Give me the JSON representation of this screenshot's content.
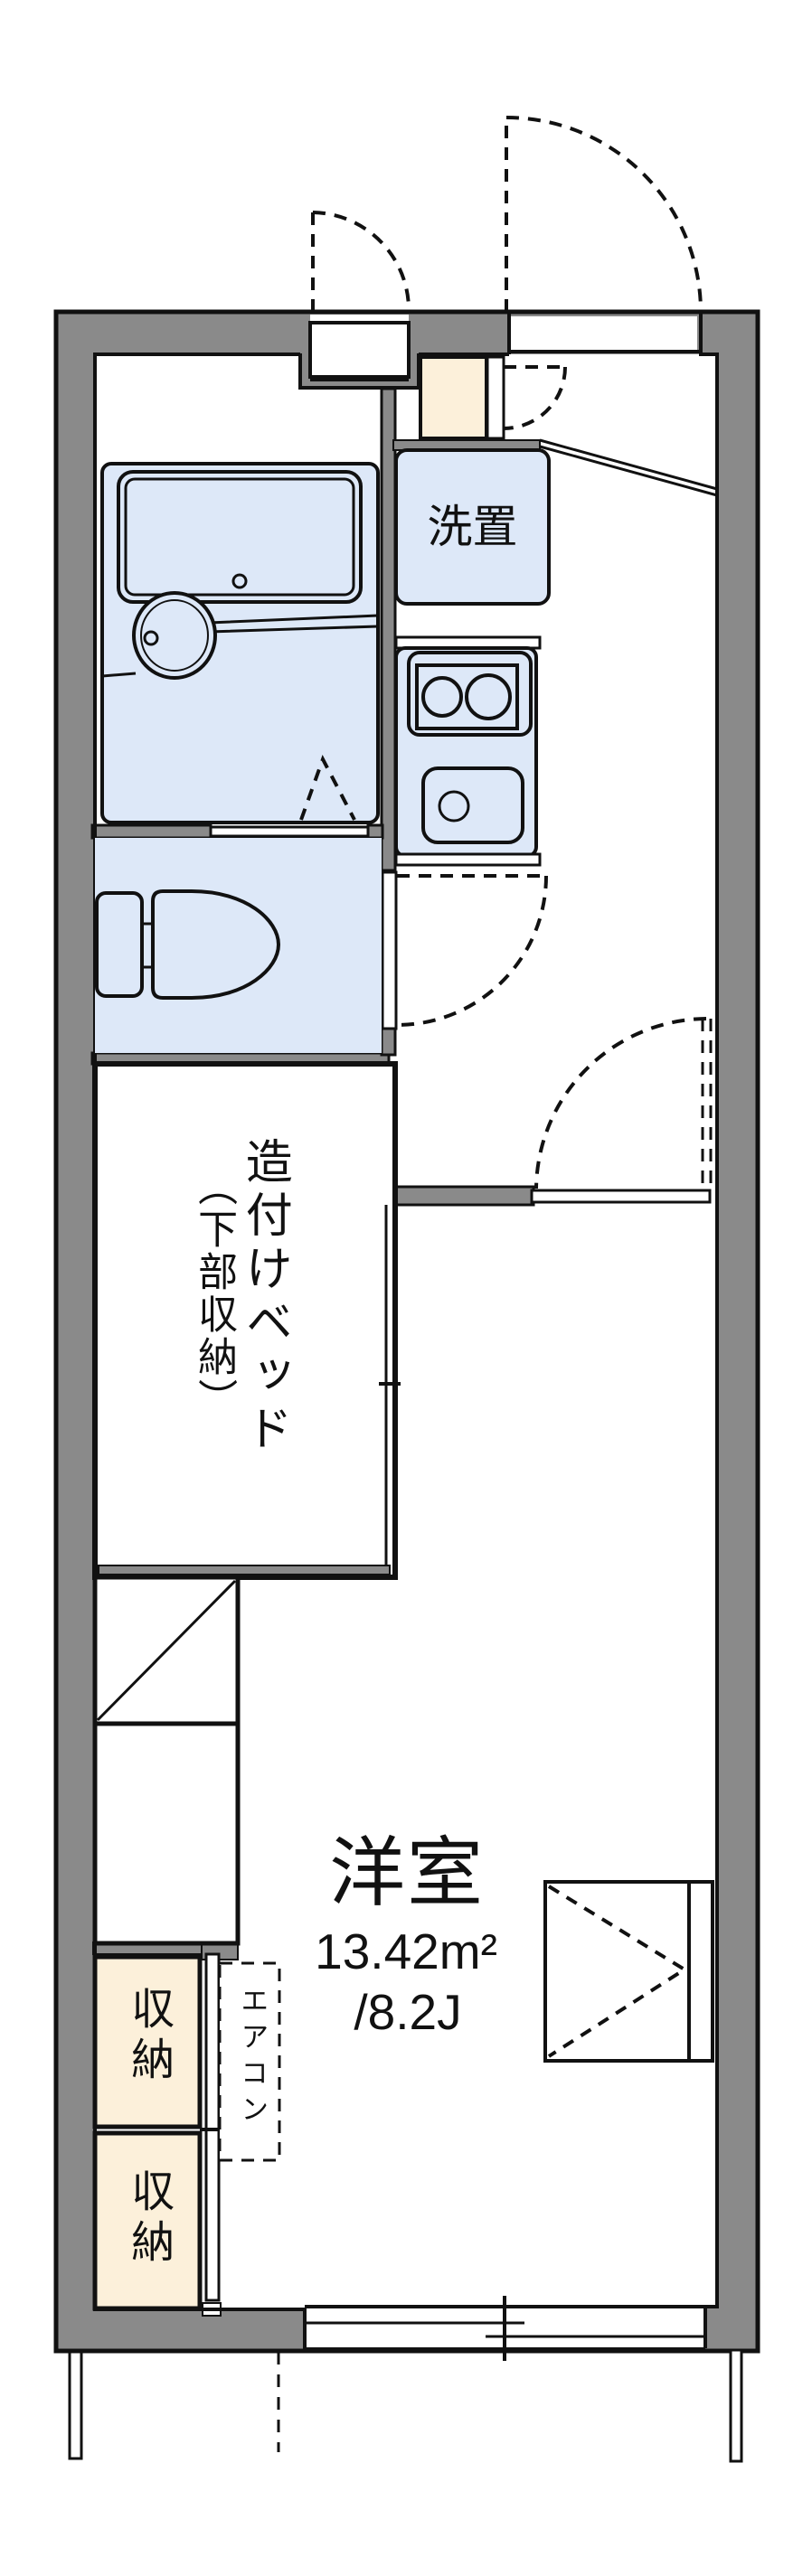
{
  "floorplan": {
    "labels": {
      "washer_area": "洗置",
      "bed_line1": "造付けベッド",
      "bed_line2": "（下部収納）",
      "room_name": "洋室",
      "room_area": "13.42m²",
      "room_size": "/8.2J",
      "storage_upper": "収納",
      "storage_lower": "収納",
      "aircon": "エアコン"
    },
    "colors": {
      "wall_gray": "#8a8a8a",
      "fixture_blue": "#dde8f8",
      "storage_beige": "#fcf0da",
      "line_black": "#111111"
    }
  }
}
